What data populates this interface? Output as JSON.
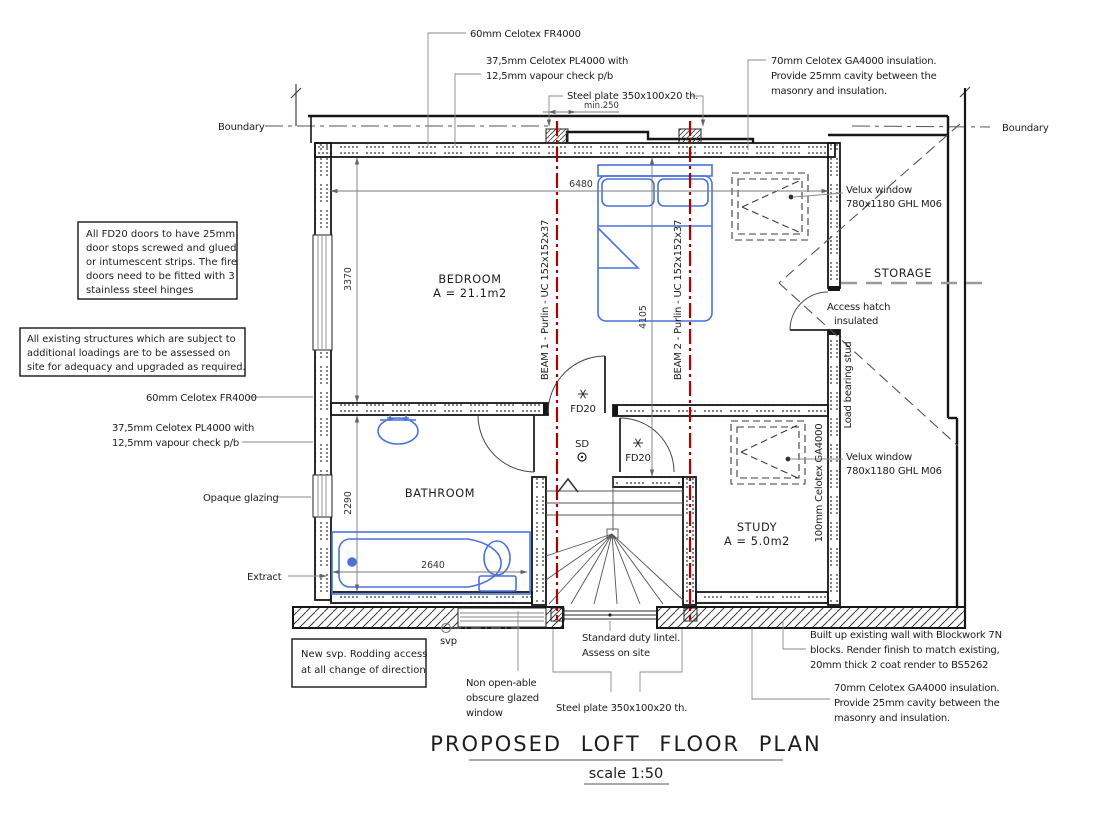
{
  "title": {
    "main": "PROPOSED LOFT FLOOR PLAN",
    "scale": "scale 1:50"
  },
  "boundary": {
    "left": "Boundary",
    "right": "Boundary"
  },
  "rooms": {
    "bedroom": {
      "name": "BEDROOM",
      "area": "A = 21.1m2"
    },
    "bathroom": {
      "name": "BATHROOM"
    },
    "study": {
      "name": "STUDY",
      "area": "A = 5.0m2"
    },
    "storage": {
      "name": "STORAGE"
    }
  },
  "doors": {
    "hall_fd20": "FD20",
    "study_fd20": "FD20",
    "smoke_detector": "SD"
  },
  "beams": {
    "beam1": "BEAM 1 - Purlin - UC 152x152x37",
    "beam2": "BEAM 2 - Purlin - UC 152x152x37"
  },
  "dimensions": {
    "overall_width": "6480",
    "hall_depth": "4105",
    "bedroom_depth": "3370",
    "bathroom_depth": "2290",
    "bath_length": "2640",
    "min_clearance": "min.250"
  },
  "callouts": {
    "celotex_fr4000_top": "60mm Celotex FR4000",
    "celotex_pl4000_top_1": "37,5mm Celotex PL4000 with",
    "celotex_pl4000_top_2": "12,5mm vapour check p/b",
    "steel_plate_top": "Steel plate 350x100x20 th.",
    "celotex_ga4000_top_1": "70mm Celotex GA4000 insulation.",
    "celotex_ga4000_top_2": "Provide 25mm cavity between the",
    "celotex_ga4000_top_3": "masonry and insulation.",
    "velux_top_1": "Velux window",
    "velux_top_2": "780x1180 GHL M06",
    "velux_study_1": "Velux window",
    "velux_study_2": "780x1180 GHL M06",
    "access_hatch_1": "Access hatch",
    "access_hatch_2": "insulated",
    "load_bearing_stud": "Load bearing stud",
    "celotex_ga4000_wall": "100mm Celotex GA4000",
    "celotex_fr4000_left": "60mm Celotex FR4000",
    "celotex_pl4000_left_1": "37,5mm Celotex PL4000 with",
    "celotex_pl4000_left_2": "12,5mm vapour check p/b",
    "opaque_glazing": "Opaque glazing",
    "extract": "Extract",
    "svp": "svp",
    "non_openable_1": "Non open-able",
    "non_openable_2": "obscure glazed",
    "non_openable_3": "window",
    "lintel_1": "Standard duty lintel.",
    "lintel_2": "Assess on site",
    "steel_plate_bottom": "Steel plate 350x100x20 th.",
    "blockwork_1": "Built up existing wall with Blockwork 7N",
    "blockwork_2": "blocks. Render finish to match existing,",
    "blockwork_3": "20mm thick 2 coat render to BS5262",
    "celotex_ga4000_bottom_1": "70mm Celotex GA4000 insulation.",
    "celotex_ga4000_bottom_2": "Provide 25mm cavity between the",
    "celotex_ga4000_bottom_3": "masonry and insulation."
  },
  "notes": {
    "fd20_box_1": "All FD20 doors to have 25mm",
    "fd20_box_2": "door stops screwed and glued",
    "fd20_box_3": "or intumescent strips. The fire",
    "fd20_box_4": "doors need to be fitted with 3",
    "fd20_box_5": "stainless steel hinges",
    "existing_box_1": "All existing structures which are subject to",
    "existing_box_2": "additional loadings are to be assessed on",
    "existing_box_3": "site for adequacy and upgraded as required.",
    "svp_box_1": "New svp. Rodding access",
    "svp_box_2": "at all change of direction"
  },
  "colors": {
    "fixture_blue": "#4a72d8",
    "beam_red": "#b00000",
    "wall_black": "#161616",
    "dim_gray": "#7a7a7a"
  }
}
